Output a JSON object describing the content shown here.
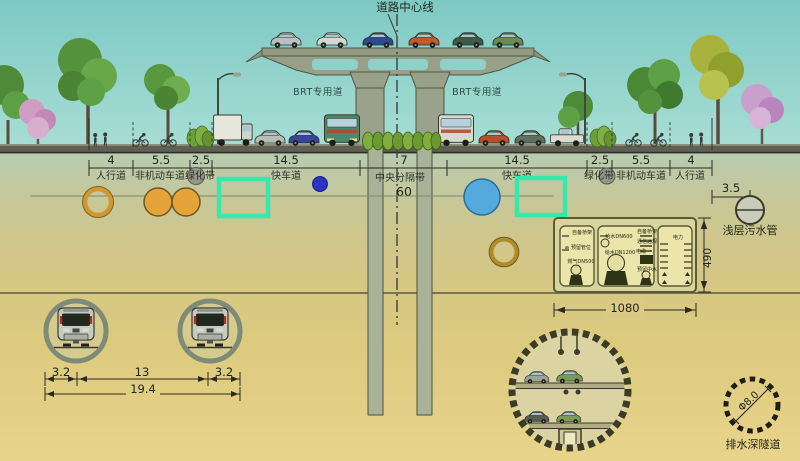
{
  "title": {
    "center_line_label": "道路中心线"
  },
  "viaduct": {
    "brt_left": "BRT专用道",
    "brt_right": "BRT专用道"
  },
  "road": {
    "dims": [
      "4",
      "5.5",
      "2.5",
      "14.5",
      "7",
      "14.5",
      "2.5",
      "5.5",
      "4"
    ],
    "lanes": [
      "人行道",
      "非机动车道",
      "绿化带",
      "快车道",
      "中央分隔带",
      "快车道",
      "绿化带",
      "非机动车道",
      "人行道"
    ],
    "total_width": "60",
    "sewer_offset_dim": "3.5",
    "sewer_pipe_label": "浅层污水管"
  },
  "utility_tunnel": {
    "width_dim": "1080",
    "depth_dim": "490",
    "gas_labels": [
      "自备桥架",
      "预留管位",
      "燃气DN500"
    ],
    "water_labels": [
      "给水DN600",
      "给水DN1200"
    ],
    "comm_labels": [
      "自备桥架",
      "通信远规",
      "电缆",
      "预留中水"
    ],
    "power_labels": [
      "电力"
    ]
  },
  "metro_tunnels": {
    "dim_left": "3.2",
    "dim_span": "13",
    "dim_right": "3.2",
    "dim_total": "19.4"
  },
  "deep_drain_tunnel": {
    "diameter_label": "Φ8.0",
    "name_label": "排水深隧道"
  },
  "colors": {
    "sky": "#8fd1ca",
    "ground_sand": "#e0cc80",
    "cyan_duct_box": "#35e8ac",
    "orange_pipe": "#e6a33b",
    "blue_pipe": "#55aadd",
    "deep_blue_valve": "#2b34c4"
  }
}
